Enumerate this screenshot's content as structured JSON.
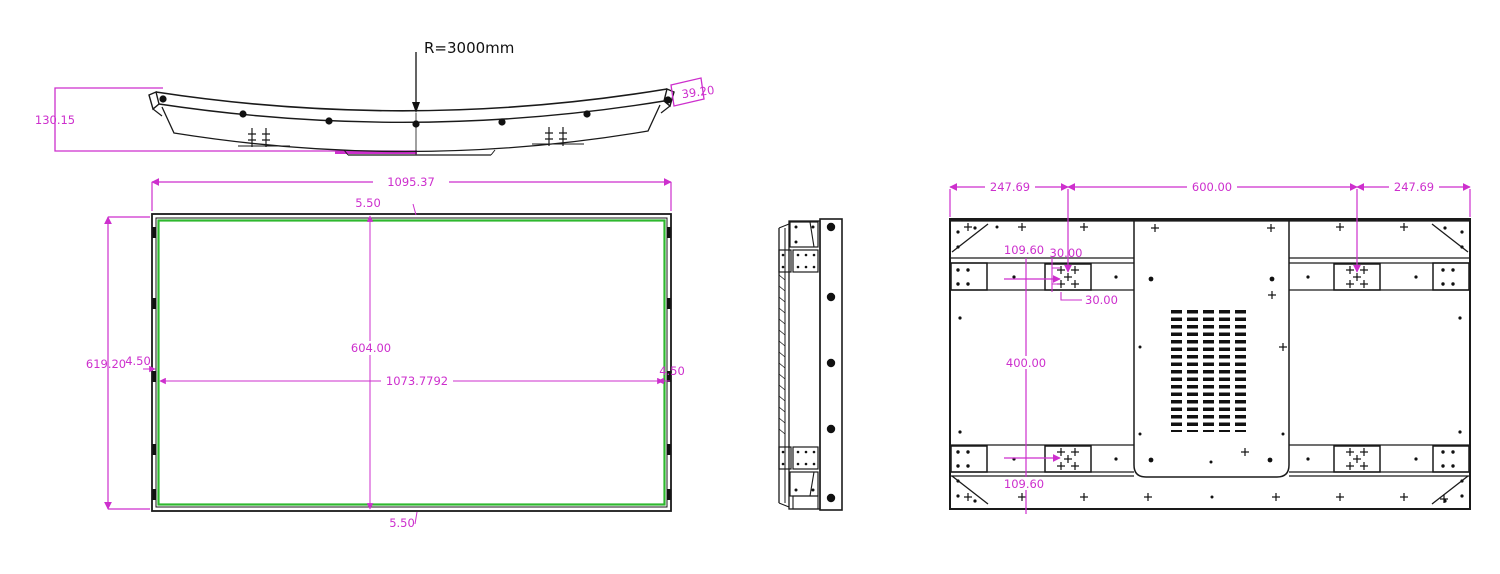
{
  "drawing": {
    "top_view": {
      "radius_label": "R=3000mm",
      "depth": "130.15",
      "end_cap_width": "39.20"
    },
    "front_view": {
      "overall_width": "1095.37",
      "overall_height": "619.20",
      "active_area_width": "1073.7792",
      "active_area_height": "604.00",
      "bezel_top": "5.50",
      "bezel_bottom": "5.50",
      "bezel_left": "4.50",
      "bezel_right": "4.50"
    },
    "back_view": {
      "mount_offset_left": "247.69",
      "mount_span": "600.00",
      "mount_offset_right": "247.69",
      "mount_top_offset": "109.60",
      "mount_bottom_offset": "109.60",
      "mount_vertical_span": "400.00",
      "hole_pitch_vertical": "30.00",
      "hole_pitch_horizontal": "30.00"
    },
    "colors": {
      "dimension_lines": "#cd2fcd",
      "active_area_outline": "#2eb82e",
      "drawing_lines": "#1a1a1a",
      "background": "#ffffff"
    }
  }
}
